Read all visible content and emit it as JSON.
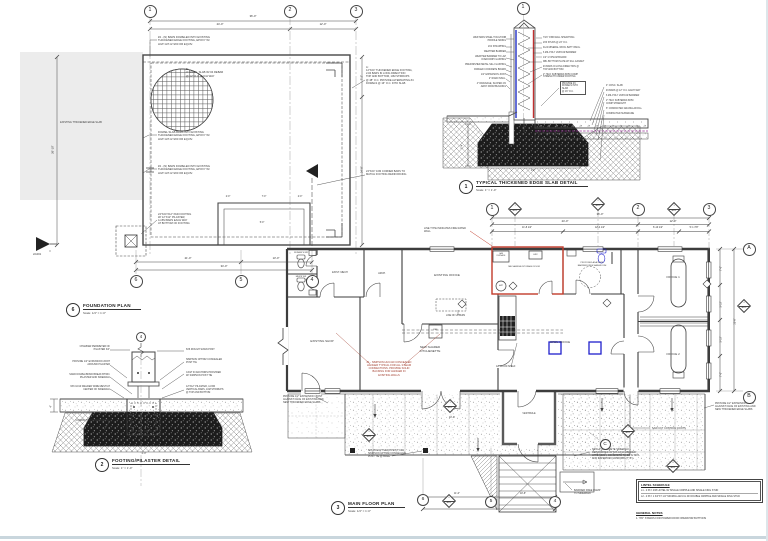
{
  "sheet": {
    "bottom_edge_color": "#c9d6dd",
    "right_edge_color": "#dde6ea"
  },
  "colors": {
    "line": "#474747",
    "fire_wall_red": "#c23b2b",
    "fixture_blue": "#2020cc",
    "poly_purple": "#993399"
  },
  "foundation": {
    "num": "6",
    "title": "FOUNDATION PLAN",
    "scale": "Scale: 1/4\" = 1'-0\"",
    "labels": [
      {
        "n": "note-dowel-top",
        "t": "#4 - (N) BARS DOWELED INTO EXISTING\nTHICKENED EDGE FOOTING, EPOXY W/\nHILTI HIT-HY200 OR EQUIV.",
        "x": 158,
        "y": 36,
        "w": 68,
        "s": 2.7
      },
      {
        "n": "slab-callout-b",
        "t": "B:\n4\" CONC. SLAB W/ #4 REBAR\n@ 12\" O.C. EACH WAY",
        "x": 186,
        "y": 68,
        "w": 56,
        "s": 2.7
      },
      {
        "n": "existing-slab-label",
        "t": "EXISTING THICKENED EDGE SLAB",
        "x": 81,
        "y": 121,
        "w": 54,
        "s": 2.5,
        "a": "c"
      },
      {
        "n": "note-dowel-mid",
        "t": "DOWEL SLAB BARS INTO EXISTING\nTHICKENED EDGE FOOTING, EPOXY W/\nHILTI HIT-HY200 OR EQUIV.",
        "x": 158,
        "y": 131,
        "w": 66,
        "s": 2.7
      },
      {
        "n": "note-dowel-bot",
        "t": "#4 - (N) BARS DOWELED INTO EXISTING\nTHICKENED EDGE FOOTING, EPOXY W/\nHILTI HIT-HY200 OR EQUIV.",
        "x": 158,
        "y": 165,
        "w": 66,
        "s": 2.7
      },
      {
        "n": "footing-callout-a",
        "t": "A:\n12\"X24\" THICKENED EDGE FOOTING,\n2-#4 BARS IN LONG DIRECTION\nTOP AND BOTTOM, 10M STIRRUPS\n@ 48\" O.C. PROVIDE ALTERNATING #4\nDOWELS @ 16\" O.C. INTO SLAB",
        "x": 366,
        "y": 66,
        "w": 58,
        "s": 2.6
      },
      {
        "n": "note-corner-bars",
        "t": "24\"X24\" 10M CORNER BARS TO\nMATCH FOOTING REINFORCING",
        "x": 366,
        "y": 170,
        "w": 54,
        "s": 2.6
      },
      {
        "n": "note-pad-footing",
        "t": "24\"X24\"X12\" PAD FOOTING\nW/ 12\"X12\" PILASTER,\n4-15M BARS EACH WAY\nAT BOTTOM OF FOOTING",
        "x": 158,
        "y": 213,
        "w": 52,
        "s": 2.6
      },
      {
        "n": "section-ref",
        "t": "2/A301",
        "x": 33,
        "y": 253,
        "s": 2.6
      }
    ],
    "dims": [
      {
        "t": "36'-0\"",
        "x": 253,
        "y": 15,
        "a": "c",
        "k": "dim"
      },
      {
        "t": "24'-0\"",
        "x": 220,
        "y": 23,
        "a": "c",
        "k": "dim"
      },
      {
        "t": "12'-0\"",
        "x": 323,
        "y": 23,
        "a": "c",
        "k": "dim"
      },
      {
        "t": "7'-2\"",
        "x": 362,
        "y": 76,
        "a": "c",
        "r": 1,
        "k": "dim"
      },
      {
        "t": "24'-8\"",
        "x": 362,
        "y": 168,
        "a": "c",
        "r": 1,
        "k": "dim"
      },
      {
        "t": "26'-10\"",
        "x": 53,
        "y": 148,
        "a": "c",
        "r": 1,
        "k": "dim"
      },
      {
        "t": "2'-0\"",
        "x": 228,
        "y": 196,
        "a": "c",
        "s": 2.3,
        "k": "dim"
      },
      {
        "t": "7'-0\"",
        "x": 264,
        "y": 196,
        "a": "c",
        "s": 2.3,
        "k": "dim"
      },
      {
        "t": "2'-0\"",
        "x": 300,
        "y": 196,
        "a": "c",
        "s": 2.3,
        "k": "dim"
      },
      {
        "t": "5'-0\"",
        "x": 262,
        "y": 222,
        "a": "c",
        "s": 2.3,
        "k": "dim"
      },
      {
        "t": "21'-0\"",
        "x": 188,
        "y": 257,
        "a": "c",
        "k": "dim"
      },
      {
        "t": "13'-0\"",
        "x": 276,
        "y": 257,
        "a": "c",
        "k": "dim"
      },
      {
        "t": "34'-0\"",
        "x": 224,
        "y": 265,
        "a": "c",
        "k": "dim"
      }
    ]
  },
  "footing": {
    "num": "2",
    "title": "FOOTING/PILASTER DETAIL",
    "scale": "Scale: 1\" = 1'-0\"",
    "labels": [
      {
        "t": "CHAMFER PERIMETER OF\nPILASTER 3/4\"",
        "x": 110,
        "y": 346,
        "w": 55,
        "a": "r",
        "s": 2.4
      },
      {
        "t": "PROVIDE 1/2\" EXPANSION JOINT\nAROUND PILASTER",
        "x": 110,
        "y": 361,
        "w": 58,
        "a": "r",
        "s": 2.4
      },
      {
        "t": "SAND DOWEL/BOND BREAK BTWN.\nPILASTER AND SIDEWALK",
        "x": 110,
        "y": 374,
        "w": 58,
        "a": "r",
        "s": 2.4
      },
      {
        "t": "6X6 10/10 WELDED WIRE MESH AT\nCENTER OF SIDEWALK",
        "x": 110,
        "y": 386,
        "w": 58,
        "a": "r",
        "s": 2.4
      },
      {
        "t": "COMPACTED GRANULAR FILL",
        "x": 110,
        "y": 420,
        "w": 55,
        "a": "r",
        "s": 2.4
      },
      {
        "t": "6X6 ROUGH SAWN POST",
        "x": 186,
        "y": 349,
        "w": 52,
        "s": 2.4
      },
      {
        "t": "SIMPSON CPT66Z CONCEALED\nPOST TIE",
        "x": 186,
        "y": 359,
        "w": 52,
        "s": 2.4
      },
      {
        "t": "CAST IN ANCHORS PROVIDED\nW/ SIMPSON POST TIE",
        "x": 186,
        "y": 372,
        "w": 52,
        "s": 2.4
      },
      {
        "t": "12\"X12\" PILASTER, 4-15M\nVERTICAL BARS, 10M STIRRUPS\n@ TOP AND BOTTOM",
        "x": 186,
        "y": 386,
        "w": 54,
        "s": 2.4
      }
    ],
    "dims": [
      {
        "t": "4\"",
        "x": 52,
        "y": 405,
        "a": "c",
        "r": 1,
        "s": 2.3,
        "k": "dim"
      },
      {
        "t": "2'-0\"",
        "x": 144,
        "y": 453,
        "a": "c",
        "s": 2.4,
        "k": "dim"
      }
    ]
  },
  "slab": {
    "num": "1",
    "title": "TYPICAL THICKENED EDGE SLAB DETAIL",
    "scale": "Scale: 1\" = 1'-0\"",
    "labels": [
      {
        "t": "WESTMAN STEEL TOUGH RIB\nPROFILE SIDING",
        "x": 506,
        "y": 37,
        "w": 50,
        "a": "r",
        "s": 2.3
      },
      {
        "t": "2X4 STRAPPING",
        "x": 506,
        "y": 46,
        "w": 50,
        "a": "r",
        "s": 2.3
      },
      {
        "t": "WEATHER BARRIER",
        "x": 506,
        "y": 51,
        "w": 50,
        "a": "r",
        "s": 2.3
      },
      {
        "t": "WEATHER BARRIER TO LAP\nOVER DRIP FLASHING",
        "x": 506,
        "y": 56,
        "w": 50,
        "a": "r",
        "s": 2.3
      },
      {
        "t": "PREFINISHED METAL SILL FLASHING",
        "x": 506,
        "y": 64,
        "w": 50,
        "a": "r",
        "s": 2.3
      },
      {
        "t": "PARGED CONCRETE BOARD",
        "x": 506,
        "y": 69,
        "w": 50,
        "a": "r",
        "s": 2.3
      },
      {
        "t": "1/2\" EXPANSION JOINT",
        "x": 506,
        "y": 73.5,
        "w": 50,
        "a": "r",
        "s": 2.3
      },
      {
        "t": "2\" RIGID INSUL.",
        "x": 506,
        "y": 78,
        "w": 50,
        "a": "r",
        "s": 2.3
      },
      {
        "t": "4\" DRAINAGE, SLOPED 2%\nAWAY FROM BUILDING",
        "x": 506,
        "y": 83,
        "w": 50,
        "a": "r",
        "s": 2.3
      },
      {
        "t": "7/16\" OSB WALL SHEATHING",
        "x": 543,
        "y": 37,
        "w": 46,
        "s": 2.3
      },
      {
        "t": "2X6 STUDS @ 24\" O.C.",
        "x": 543,
        "y": 42,
        "w": 46,
        "s": 2.3
      },
      {
        "t": "R-24 MINERAL WOOL BATT INSUL.",
        "x": 543,
        "y": 47,
        "w": 46,
        "s": 2.3
      },
      {
        "t": "6 MIL POLY VAPOUR BARRIER",
        "x": 543,
        "y": 52,
        "w": 46,
        "s": 2.3
      },
      {
        "t": "1/2\" GYPSUM BOARD",
        "x": 543,
        "y": 56.5,
        "w": 46,
        "s": 2.3
      },
      {
        "t": "DBL BOTTOM PLATE W/ SILL GASKET",
        "x": 543,
        "y": 61,
        "w": 48,
        "s": 2.3
      },
      {
        "t": "#4 BARS IN LONG DIRECTION @\nTOP AND BOTTOM",
        "x": 543,
        "y": 66,
        "w": 46,
        "s": 2.3
      },
      {
        "t": "2\" HILO SUBTERRA 50/50 COMP\nSTRENGTH UNDER FOOTING",
        "x": 543,
        "y": 73.5,
        "w": 46,
        "s": 2.3
      },
      {
        "t": "PROVIDE #4\nDOWELS INTO SLAB\n@ 16\" O.C.",
        "x": 560,
        "y": 81,
        "w": 26,
        "s": 2.3,
        "box": 1
      },
      {
        "t": "4\" CONC. SLAB",
        "x": 606,
        "y": 85,
        "w": 46,
        "s": 2.3
      },
      {
        "t": "#4 BARS @ 12\" O.C. EACH WAY",
        "x": 606,
        "y": 90,
        "w": 46,
        "s": 2.3
      },
      {
        "t": "6 MIL POLY VAPOUR BARRIER",
        "x": 606,
        "y": 95,
        "w": 46,
        "s": 2.3
      },
      {
        "t": "2\" HILO SUBTERRA 50/50\nCOMP STRENGTH",
        "x": 606,
        "y": 100,
        "w": 46,
        "s": 2.3
      },
      {
        "t": "6\" COMPACTED GRANULAR FILL",
        "x": 606,
        "y": 108,
        "w": 46,
        "s": 2.3
      },
      {
        "t": "COMPACTED SUBGRADE",
        "x": 606,
        "y": 113,
        "w": 46,
        "s": 2.3
      }
    ],
    "dims": [
      {
        "t": "1'-4\"",
        "x": 463,
        "y": 145,
        "a": "c",
        "r": 1,
        "s": 2.3,
        "k": "dim"
      },
      {
        "t": "2'-0\"",
        "x": 533,
        "y": 170,
        "a": "c",
        "s": 2.3,
        "k": "dim"
      }
    ]
  },
  "plan": {
    "num": "3",
    "title": "MAIN FLOOR PLAN",
    "scale": "Scale: 1/4\" = 1'-0\"",
    "rooms": [
      {
        "t": "WOMEN'S WR",
        "x": 301,
        "y": 252,
        "a": "c",
        "s": 2.1
      },
      {
        "t": "MEN'S WR",
        "x": 301,
        "y": 276,
        "a": "c",
        "s": 2.1
      },
      {
        "t": "EXIST. MECH",
        "x": 340,
        "y": 271,
        "a": "c",
        "s": 2.5
      },
      {
        "t": "ARCH.",
        "x": 382,
        "y": 272,
        "a": "c",
        "s": 2.5
      },
      {
        "t": "EXISTING OFFICE",
        "x": 447,
        "y": 274,
        "a": "c",
        "s": 3
      },
      {
        "t": "EXISTING SHOP",
        "x": 322,
        "y": 340,
        "a": "c",
        "s": 3
      },
      {
        "t": "NEW SHARED KITCHENETTE",
        "x": 430,
        "y": 346,
        "a": "c",
        "s": 3
      },
      {
        "t": "MECHANICAL/STORAGE ROOM",
        "x": 524,
        "y": 266,
        "a": "c",
        "s": 2.1,
        "w": 50
      },
      {
        "t": "GAS\nFURNACE",
        "x": 501,
        "y": 252.5,
        "a": "c",
        "s": 1.8
      },
      {
        "t": "HRV",
        "x": 535.5,
        "y": 253.5,
        "a": "c",
        "s": 2
      },
      {
        "t": "HWT",
        "x": 501,
        "y": 284.5,
        "a": "c",
        "s": 1.9
      },
      {
        "t": "PROPOSED ADA SUITE\nBARRIER FREE WASHROOM",
        "x": 592,
        "y": 262,
        "a": "c",
        "s": 2.1,
        "w": 40
      },
      {
        "t": "OPEN OFFICE",
        "x": 560,
        "y": 341,
        "a": "c",
        "s": 3
      },
      {
        "t": "OFFICE 1",
        "x": 673,
        "y": 276,
        "a": "c",
        "s": 3
      },
      {
        "t": "OFFICE 2",
        "x": 673,
        "y": 353,
        "a": "c",
        "s": 3
      },
      {
        "t": "VESTIBULE",
        "x": 529,
        "y": 413,
        "a": "c",
        "s": 2.4
      },
      {
        "t": "REF",
        "x": 435.5,
        "y": 329,
        "a": "c",
        "s": 2.1
      }
    ],
    "notes": [
      {
        "t": "LINE TYPE INDICATES FIRE RATED WALL",
        "x": 424,
        "y": 227,
        "w": 46,
        "s": 2.5
      },
      {
        "t": "LINE OF UPPERS",
        "x": 446,
        "y": 315,
        "s": 2.3
      },
      {
        "t": "12\" WOOD SHELF",
        "x": 496,
        "y": 366,
        "s": 2.3
      },
      {
        "t": "#1 - SIMPSON HUC410 CONCEALED\nHANGER TYPICAL FOR ALL 3 BEAM\nCONNECTIONS. PROVIDE SOLID\nBACKING FOR HANGER IN\nEXISTING WALLS",
        "x": 389,
        "y": 361,
        "a": "c",
        "w": 56,
        "s": 2.6,
        "c": "#a03a2a"
      },
      {
        "t": "PROVIDE 1/2\" EXPANSION JOINT\nAGAINST FACE OF EXISTING AND\nNEW THICKENED EDGE SLABS",
        "x": 283,
        "y": 395,
        "w": 46,
        "s": 2.5
      },
      {
        "t": "6X6 ROUGH SAWN POST, C/W\nSIMPSON CPT66Z CONCEALED\nPOST TIE @ BASE",
        "x": 368,
        "y": 449,
        "w": 44,
        "s": 2.5
      },
      {
        "t": "NEW 4\" CONCRETE SIDEWALK,\nREINFORCED W/ 6X6 10/10 WELDED\nWIRE MESH, CONCRETE TO BE 32 MPA\nFOR EXTERIOR FLATWORK (TYP.)",
        "x": 592,
        "y": 448,
        "w": 52,
        "s": 2.5
      },
      {
        "t": "SAW CUT CONTROL JOINTS",
        "x": 652,
        "y": 427,
        "s": 2.5
      },
      {
        "t": "PROVIDE 1/2\" EXPANSION JOINT\nAGAINST FACE OF EXISTING AND\nNEW THICKENED EDGE SLABS",
        "x": 715,
        "y": 402,
        "w": 46,
        "s": 2.5
      },
      {
        "t": "BARRIER FREE RAMP\nTO SIDEWALK",
        "x": 574,
        "y": 489,
        "w": 34,
        "s": 2.5
      }
    ],
    "dims": [
      {
        "t": "36'-0\"",
        "x": 600,
        "y": 213,
        "a": "c",
        "k": "dim"
      },
      {
        "t": "24'-0\"",
        "x": 565,
        "y": 219.5,
        "a": "c",
        "k": "dim"
      },
      {
        "t": "12'-0\"",
        "x": 673,
        "y": 219.5,
        "a": "c",
        "k": "dim"
      },
      {
        "t": "11'-8 1/2\"",
        "x": 527,
        "y": 226.5,
        "a": "c",
        "s": 2.4,
        "k": "dim"
      },
      {
        "t": "12'-4 1/2\"",
        "x": 600,
        "y": 226.5,
        "a": "c",
        "s": 2.4,
        "k": "dim"
      },
      {
        "t": "6'-10 1/2\"",
        "x": 658,
        "y": 226.5,
        "a": "c",
        "s": 2.4,
        "k": "dim"
      },
      {
        "t": "5'-1 7/8\"",
        "x": 694,
        "y": 226.5,
        "a": "c",
        "s": 2.4,
        "k": "dim"
      },
      {
        "t": "7'-0\"",
        "x": 722,
        "y": 267,
        "a": "c",
        "r": 1,
        "s": 2.4,
        "k": "dim"
      },
      {
        "t": "5'-10\"",
        "x": 722,
        "y": 303,
        "a": "c",
        "r": 1,
        "s": 2.4,
        "k": "dim"
      },
      {
        "t": "5'-10\"",
        "x": 722,
        "y": 338,
        "a": "c",
        "r": 1,
        "s": 2.4,
        "k": "dim"
      },
      {
        "t": "7'-0\"",
        "x": 722,
        "y": 373,
        "a": "c",
        "r": 1,
        "s": 2.4,
        "k": "dim"
      },
      {
        "t": "25'-8\"",
        "x": 736,
        "y": 320,
        "a": "c",
        "r": 1,
        "s": 2.4,
        "k": "dim"
      },
      {
        "t": "11'-0\"",
        "x": 457,
        "y": 492.5,
        "a": "c",
        "s": 2.4,
        "k": "dim"
      },
      {
        "t": "10'-6\"",
        "x": 523,
        "y": 492.5,
        "a": "c",
        "s": 2.4,
        "k": "dim"
      },
      {
        "t": "21'-6\"",
        "x": 489,
        "y": 504.5,
        "a": "c",
        "s": 2.4,
        "k": "dim"
      },
      {
        "t": "10'-0\"",
        "x": 452,
        "y": 417,
        "a": "c",
        "s": 2.4,
        "k": "dim"
      }
    ]
  },
  "bubbles": [
    {
      "t": "1",
      "x": 150,
      "y": 11
    },
    {
      "t": "2",
      "x": 290,
      "y": 11
    },
    {
      "t": "3",
      "x": 356,
      "y": 11
    },
    {
      "t": "6",
      "x": 136,
      "y": 281
    },
    {
      "t": "5",
      "x": 241,
      "y": 281
    },
    {
      "t": "4",
      "x": 312,
      "y": 281
    },
    {
      "t": "4",
      "x": 141,
      "y": 337,
      "r": 5
    },
    {
      "t": "1",
      "x": 523,
      "y": 8
    },
    {
      "t": "1",
      "x": 492,
      "y": 209
    },
    {
      "t": "2",
      "x": 638,
      "y": 209
    },
    {
      "t": "3",
      "x": 709,
      "y": 209
    },
    {
      "t": "A",
      "x": 749,
      "y": 249
    },
    {
      "t": "B",
      "x": 749,
      "y": 397
    },
    {
      "t": "C",
      "x": 605,
      "y": 444,
      "r": 5.5
    },
    {
      "t": "6",
      "x": 423,
      "y": 500,
      "r": 6
    },
    {
      "t": "5",
      "x": 491,
      "y": 502,
      "r": 6
    },
    {
      "t": "4",
      "x": 555,
      "y": 502,
      "r": 6
    }
  ],
  "diamonds": [
    {
      "x": 515,
      "y": 209,
      "a": "1",
      "b": "A301"
    },
    {
      "x": 598,
      "y": 204,
      "a": "2",
      "b": "A302"
    },
    {
      "x": 674,
      "y": 209,
      "a": "3",
      "b": "A301"
    },
    {
      "x": 744,
      "y": 306,
      "a": "4",
      "b": "A302"
    },
    {
      "x": 450,
      "y": 406,
      "a": "1",
      "b": "A301"
    },
    {
      "x": 369,
      "y": 435,
      "a": "5",
      "b": "A301"
    },
    {
      "x": 449,
      "y": 501,
      "a": "6",
      "b": "A301"
    },
    {
      "x": 628,
      "y": 431,
      "a": "7",
      "b": "A301"
    },
    {
      "x": 673,
      "y": 466,
      "a": "8",
      "b": "A301"
    }
  ],
  "legend": {
    "title": "LINTEL SCHEDULE",
    "rows": [
      "L1 - 2 PLY 2X8 LINTEL W/ SINGLE CRIPPLE AND SINGLE KING STUD",
      "L2 - 2 PLY 1 3/4\"X7 1/4\" MICROLLAM LVL W/ DOUBLE CRIPPLE AND SINGLE KING STUD"
    ]
  },
  "general_notes": {
    "title": "GENERAL NOTES",
    "items": [
      "1. \"PD\" STANDS FOR POWER DOOR OPERATOR BUTTONS"
    ]
  }
}
